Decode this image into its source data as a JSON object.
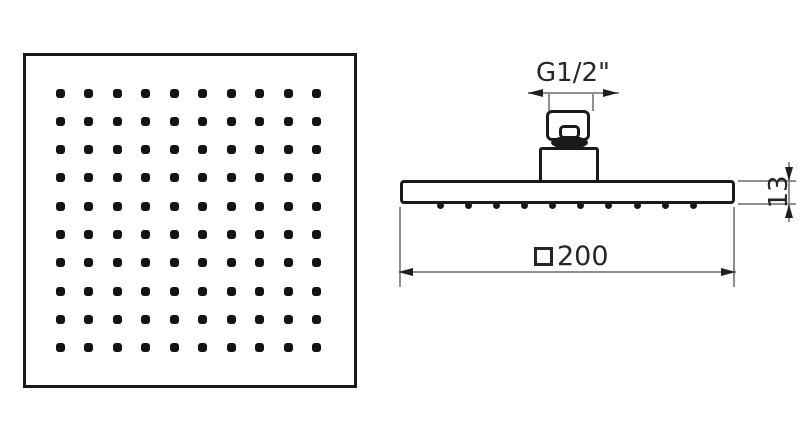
{
  "drawing": {
    "subject": "Square overhead rain shower head technical drawing",
    "background": "#ffffff"
  },
  "front_view": {
    "nozzle_rows": 10,
    "nozzle_cols": 10
  },
  "side_view": {
    "nozzle_count": 10
  },
  "dimensions": {
    "thread": {
      "label": "G1/2\""
    },
    "thickness": {
      "label": "13"
    },
    "width": {
      "symbol": "□",
      "label": "200"
    }
  },
  "colors": {
    "outline": "#1a1a1a",
    "dimension_line": "#8f8f8f",
    "text": "#262626"
  }
}
